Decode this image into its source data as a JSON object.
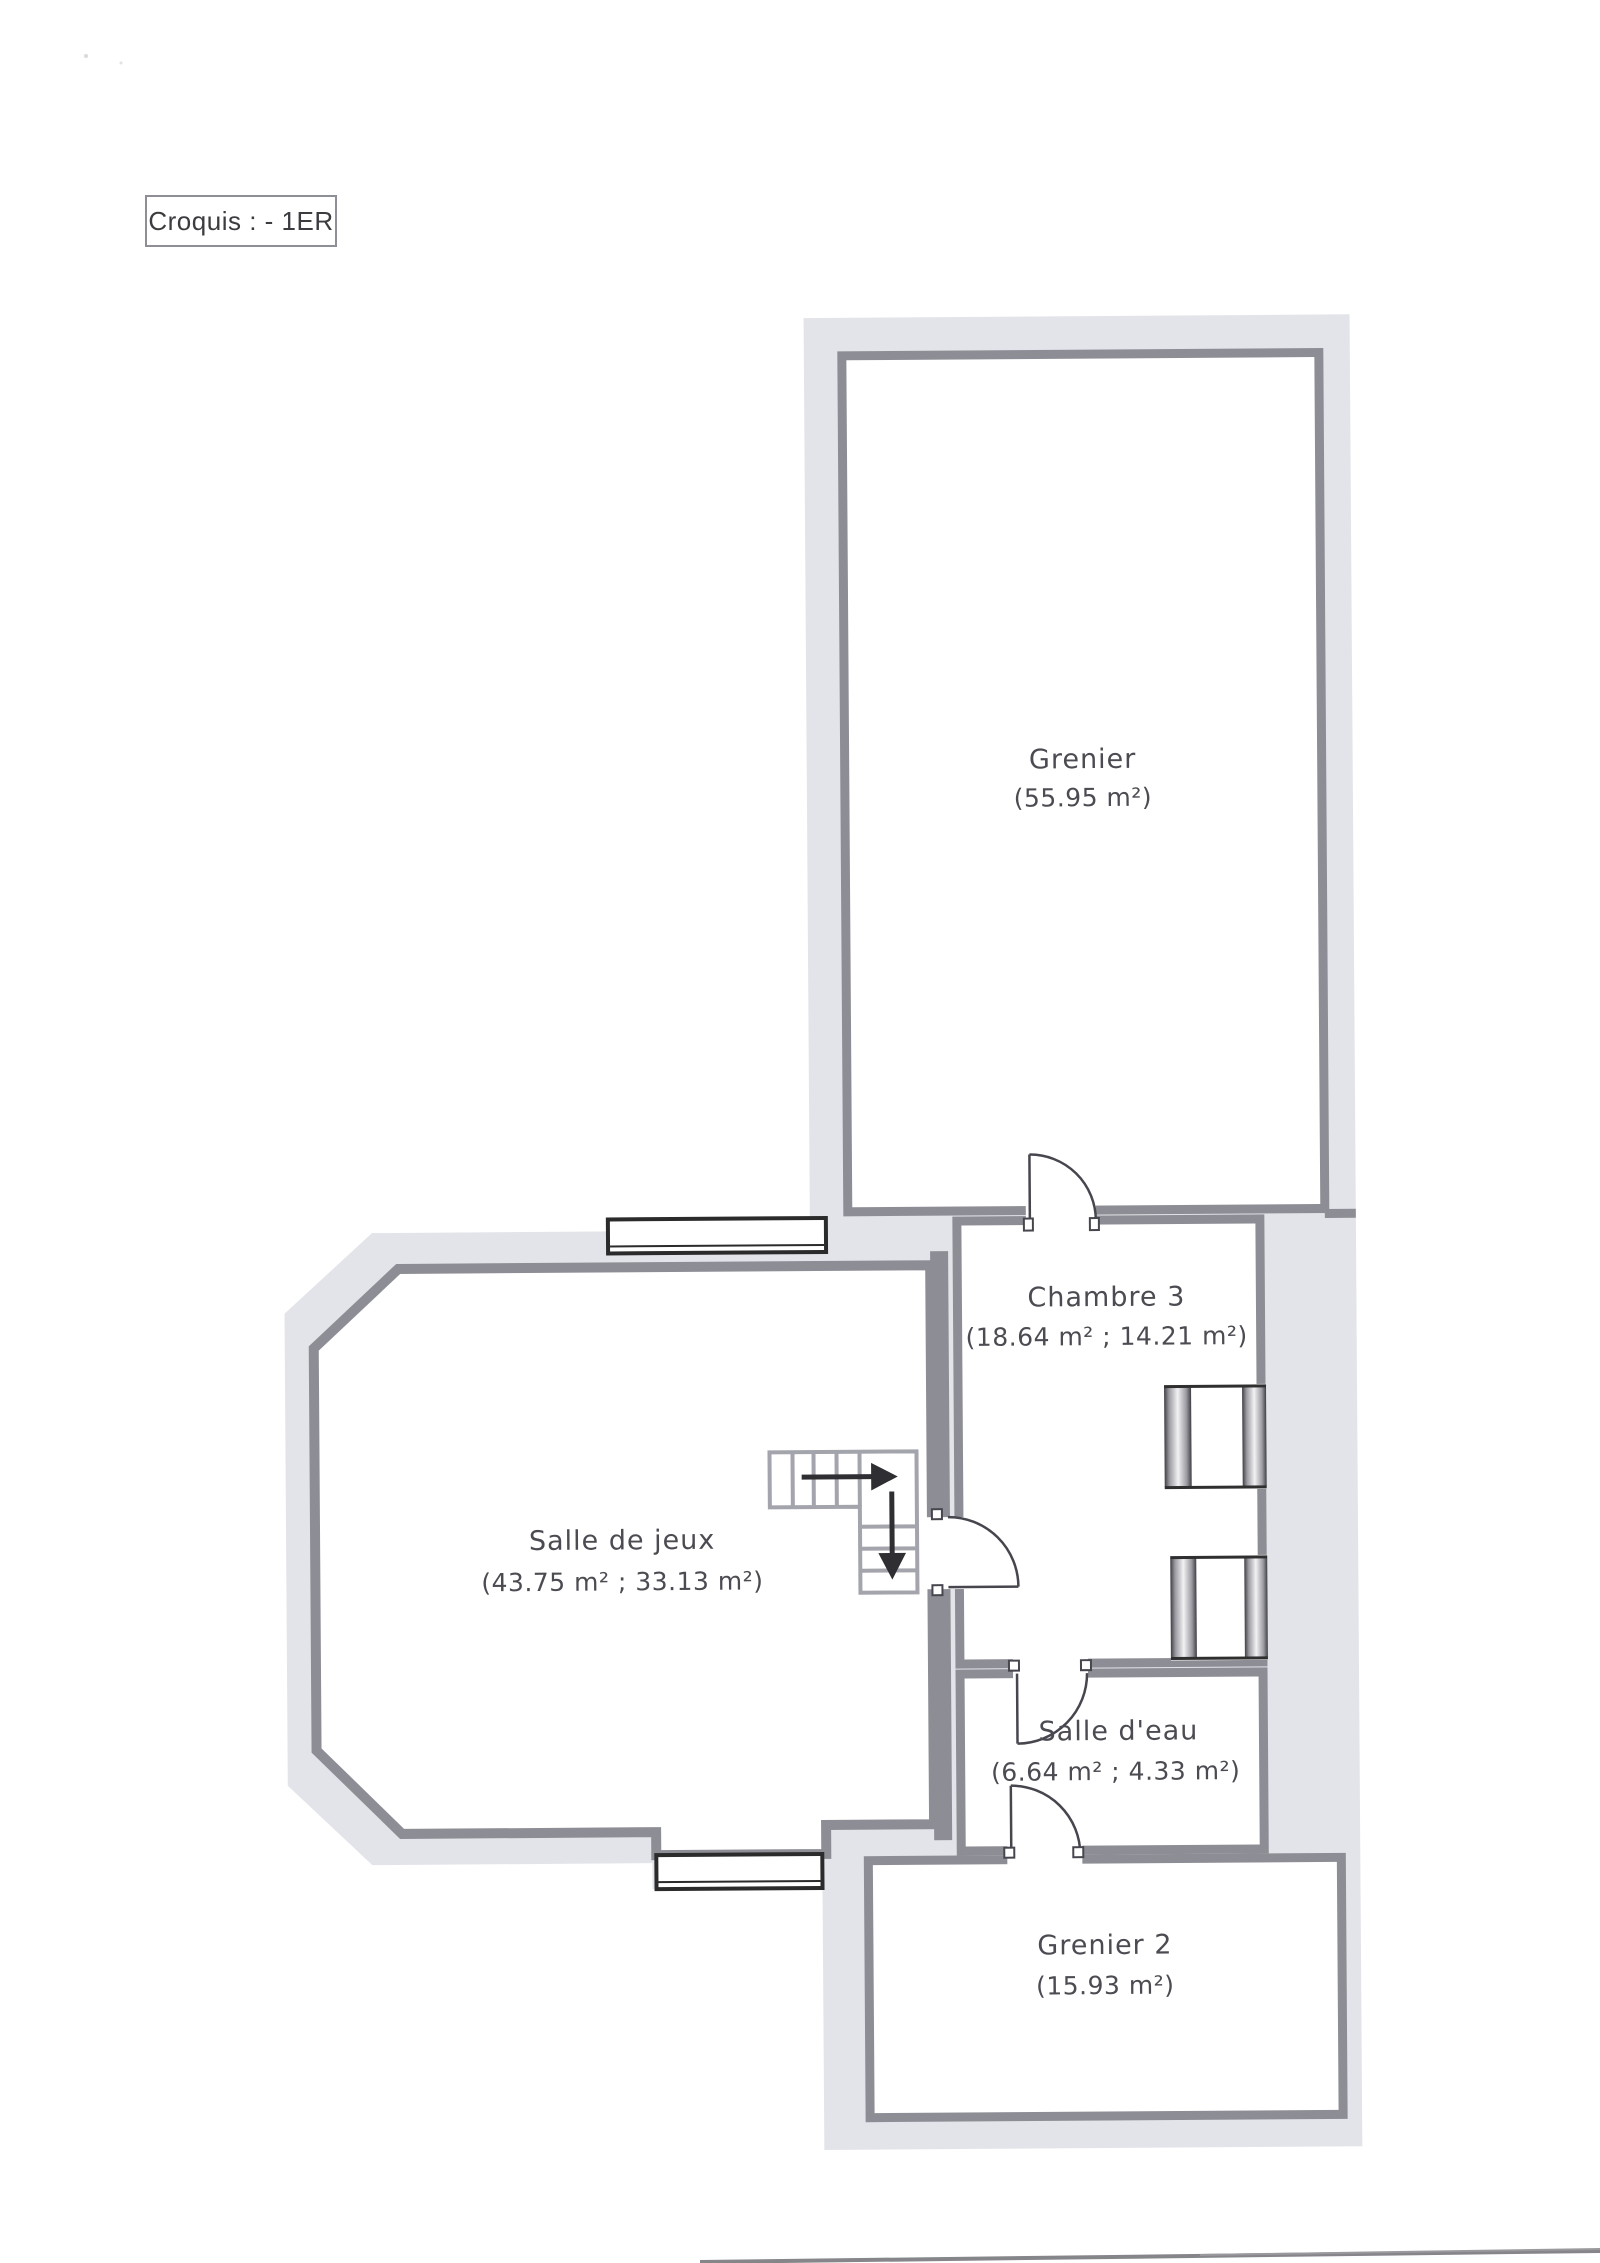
{
  "title_box": {
    "label": "Croquis : - 1ER"
  },
  "floor_plan": {
    "rooms": [
      {
        "id": "grenier",
        "name": "Grenier",
        "area": "(55.95 m²)"
      },
      {
        "id": "chambre3",
        "name": "Chambre 3",
        "area": "(18.64 m² ; 14.21 m²)"
      },
      {
        "id": "salle_de_jeux",
        "name": "Salle de jeux",
        "area": "(43.75 m² ; 33.13 m²)"
      },
      {
        "id": "salle_deau",
        "name": "Salle d'eau",
        "area": "(6.64 m² ; 4.33 m²)"
      },
      {
        "id": "grenier2",
        "name": "Grenier 2",
        "area": "(15.93 m²)"
      }
    ],
    "symbols": {
      "staircase": "L-shaped stair with direction arrows",
      "windows": "2 window symbols",
      "doors": "4 door swing symbols",
      "radiators": "2 radiator symbols"
    },
    "colors": {
      "wall_band": "#e3e4e9",
      "wall_line": "#8d8d95",
      "window_frame": "#2b2b2b",
      "door_line": "#46464e",
      "stair_line": "#a3a4ac",
      "arrow": "#2f2f33",
      "label_text": "#4b4b52"
    }
  }
}
